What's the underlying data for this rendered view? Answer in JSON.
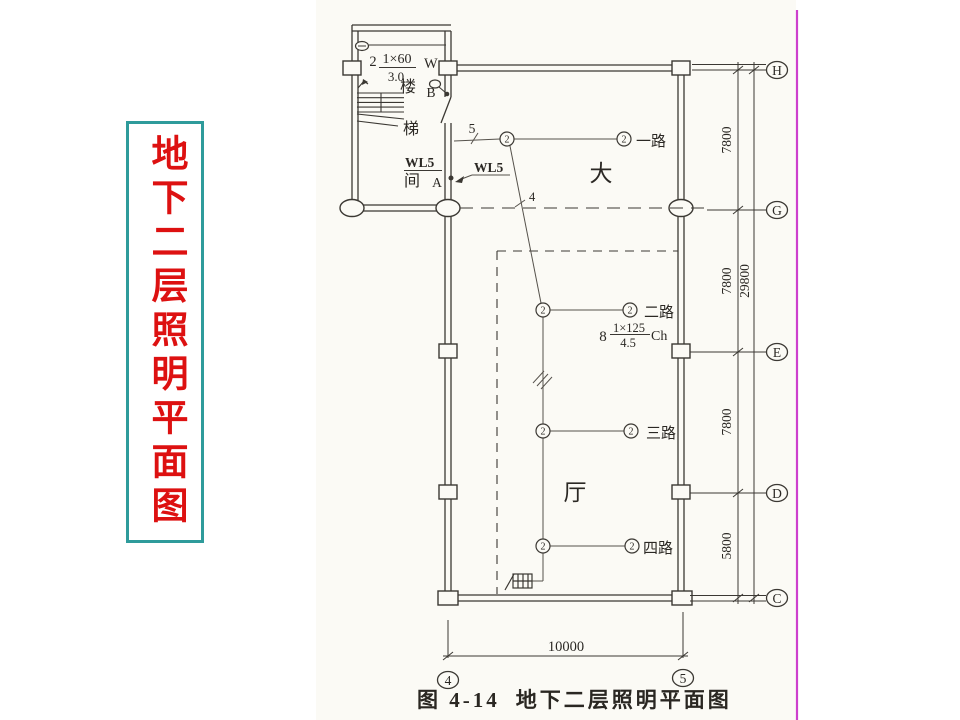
{
  "slide_title": {
    "text": "地下二层照明平面图"
  },
  "caption": {
    "prefix": "图 4-14",
    "title": "地下二层照明平面图"
  },
  "colors": {
    "title_red": "#dd1111",
    "title_border": "#2e9b9b",
    "accent_line": "#cd3fcd",
    "ink": "#3b3833"
  },
  "rooms": {
    "stair_upper": "楼",
    "stair_mid": "梯",
    "stair_lower": "间",
    "hall_upper": "大",
    "hall_lower": "厅"
  },
  "feeder": {
    "label_wall": "WL5",
    "label_wire": "WL5",
    "point_a": "A",
    "point_b": "B"
  },
  "wire_counts": {
    "five": "5",
    "four": "4"
  },
  "luminaires": {
    "stair": {
      "count": "2",
      "lamp": "1×60",
      "height": "3.0",
      "type": "W"
    },
    "hall": {
      "count": "8",
      "lamp": "1×125",
      "height": "4.5",
      "type": "Ch"
    }
  },
  "circuits": {
    "r1": "一路",
    "r2": "二路",
    "r3": "三路",
    "r4": "四路"
  },
  "lamp_symbol": "2",
  "grid": {
    "h": "H",
    "g": "G",
    "e": "E",
    "d": "D",
    "c": "C",
    "v4": "4",
    "v5": "5"
  },
  "dims": {
    "hg": "7800",
    "ge": "7800",
    "ed": "7800",
    "dc": "5800",
    "total": "29800",
    "bottom": "10000"
  }
}
